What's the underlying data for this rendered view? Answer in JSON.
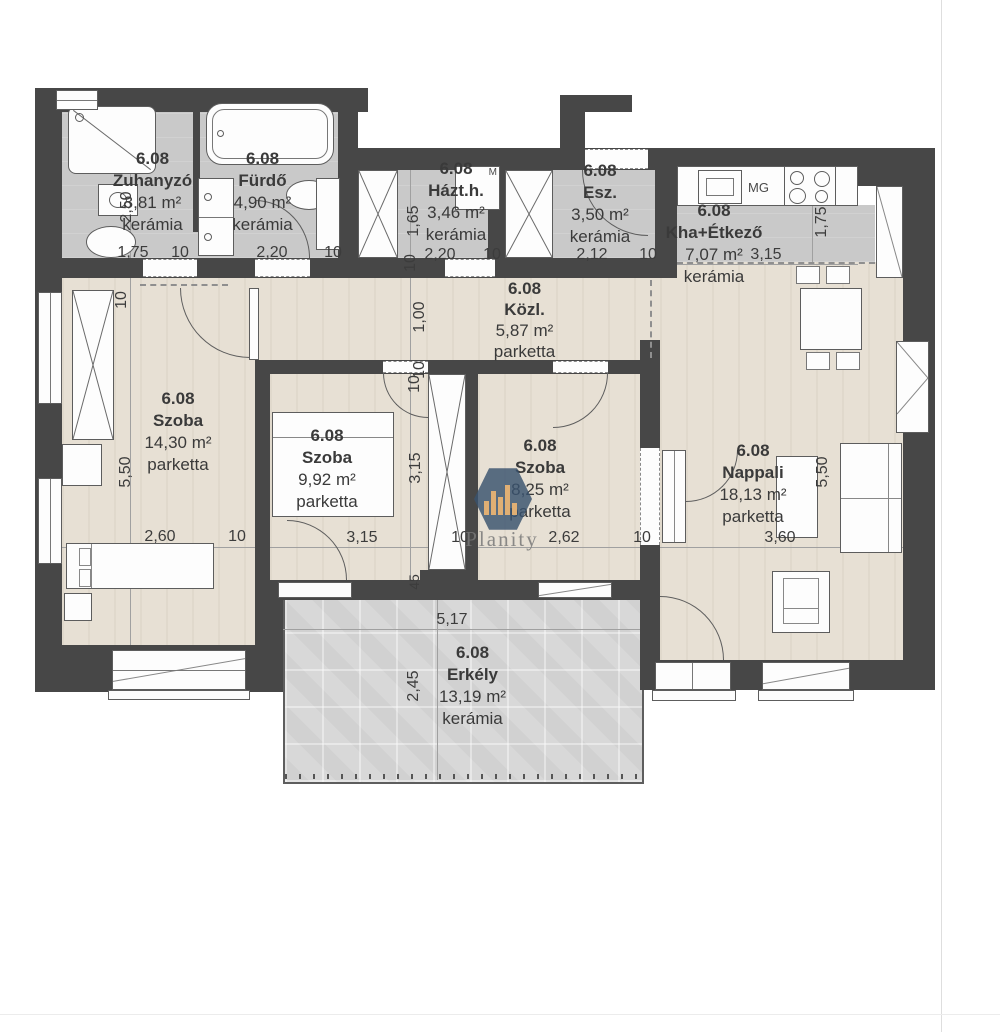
{
  "unit": "6.08",
  "rooms": [
    {
      "number": "6.08",
      "name": "Zuhanyzó",
      "area": "3,81 m²",
      "floor": "kerámia"
    },
    {
      "number": "6.08",
      "name": "Fürdő",
      "area": "4,90 m²",
      "floor": "kerámia"
    },
    {
      "number": "6.08",
      "name": "Házt.h.",
      "area": "3,46 m²",
      "floor": "kerámia"
    },
    {
      "number": "6.08",
      "name": "Esz.",
      "area": "3,50 m²",
      "floor": "kerámia"
    },
    {
      "number": "6.08",
      "name": "Kha+Étkező",
      "area": "7,07 m²",
      "floor": "kerámia"
    },
    {
      "number": "6.08",
      "name": "Közl.",
      "area": "5,87 m²",
      "floor": "parketta"
    },
    {
      "number": "6.08",
      "name": "Szoba",
      "area": "14,30 m²",
      "floor": "parketta"
    },
    {
      "number": "6.08",
      "name": "Szoba",
      "area": "9,92 m²",
      "floor": "parketta"
    },
    {
      "number": "6.08",
      "name": "Szoba",
      "area": "8,25 m²",
      "floor": "parketta"
    },
    {
      "number": "6.08",
      "name": "Nappali",
      "area": "18,13 m²",
      "floor": "parketta"
    },
    {
      "number": "6.08",
      "name": "Erkély",
      "area": "13,19 m²",
      "floor": "kerámia"
    }
  ],
  "dims": {
    "zuh_h": "2,50",
    "zuh_w": "1,75",
    "t10_1": "10",
    "furdo_w": "2,20",
    "t10_2": "10",
    "hazt_h": "1,65",
    "t10_3": "10",
    "hazt_w": "2,20",
    "t10_4": "10",
    "esz_w": "2,12",
    "t10_5": "10",
    "kha_w": "3,15",
    "kha_h": "1,75",
    "kozl_h": "1,00",
    "t10_6": "10",
    "t10_7": "10",
    "szoba1_h": "5,50",
    "szoba1_w": "2,60",
    "t10_8": "10",
    "szoba2_w": "3,15",
    "szoba2_h": "3,15",
    "t10_9": "10",
    "t10_10": "10",
    "szoba3_w": "2,62",
    "t10_11": "10",
    "nappali_w": "3,60",
    "nappali_h": "5,50",
    "erkely_w": "5,17",
    "erkely_h": "2,45",
    "wall45": "45"
  },
  "labels": {
    "m": "M",
    "mg": "MG"
  },
  "watermark": {
    "text": "Planity"
  },
  "colors": {
    "wall": "#474747",
    "parketta": "#e7e0d4",
    "keramia": "#c9c9c9",
    "balcony": "#d8d8d8",
    "watermark_hex": "#38526e",
    "watermark_bars": "#e0af74"
  }
}
